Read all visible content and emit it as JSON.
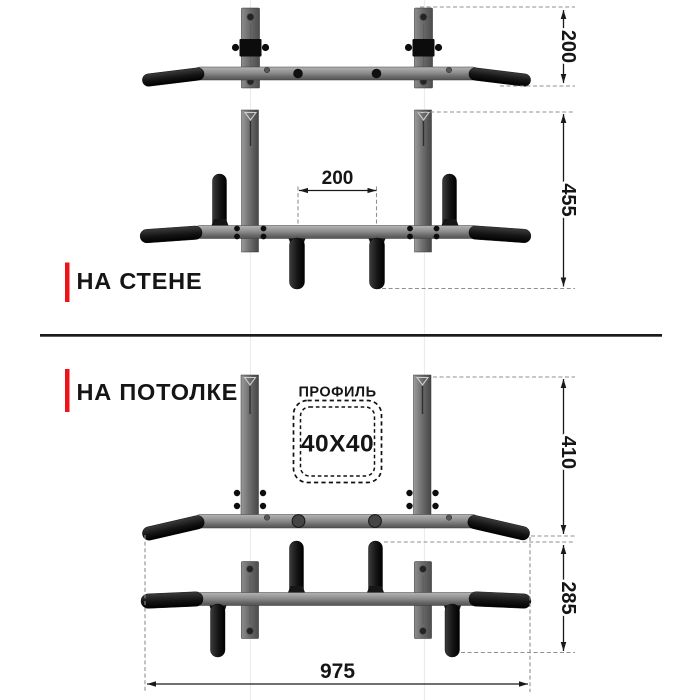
{
  "sections": {
    "wall": {
      "label": "НА СТЕНЕ"
    },
    "ceiling": {
      "label": "НА ПОТОЛКЕ"
    }
  },
  "profile": {
    "title": "ПРОФИЛЬ",
    "value": "40X40"
  },
  "dimensions": {
    "bracket_height": "200",
    "wall_height": "455",
    "grip_spacing": "200",
    "ceiling_height": "410",
    "frame_height": "285",
    "overall_width": "975"
  },
  "colors": {
    "accent_red": "#ee1318",
    "ink": "#1a1a1a",
    "metal_gray": "#7f7f7f",
    "grip_black": "#141414",
    "dash_gray": "#8f8f8f"
  }
}
